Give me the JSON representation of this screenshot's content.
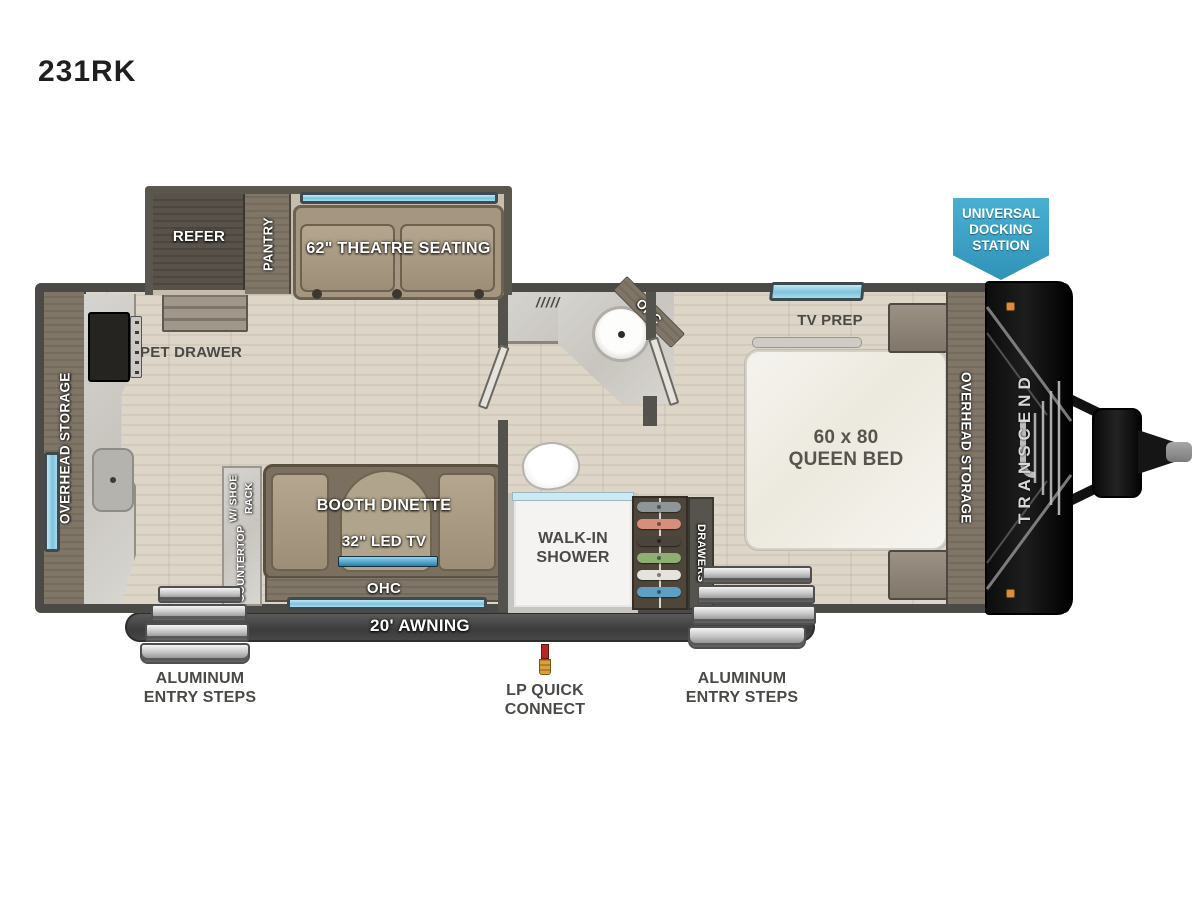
{
  "title": "231RK",
  "badge": {
    "line1": "UNIVERSAL",
    "line2": "DOCKING",
    "line3": "STATION"
  },
  "slideout": {
    "refer": "REFER",
    "pantry": "PANTRY",
    "theatre": "62\" THEATRE SEATING"
  },
  "kitchen": {
    "overhead_storage": "OVERHEAD STORAGE",
    "pet_drawer": "PET DRAWER"
  },
  "dinette": {
    "countertop_line1": "COUNTERTOP",
    "countertop_line2": "W/ SHOE RACK",
    "booth": "BOOTH DINETTE",
    "tv": "32\" LED TV",
    "ohc": "OHC"
  },
  "bath": {
    "vent_marks": "/////",
    "ohc": "OHC",
    "shower_line1": "WALK-IN",
    "shower_line2": "SHOWER",
    "drawers": "DRAWERS"
  },
  "bedroom": {
    "tv_prep": "TV PREP",
    "bed_line1": "60 x 80",
    "bed_line2": "QUEEN BED",
    "overhead_storage": "OVERHEAD STORAGE"
  },
  "front": {
    "brand": "TRANSCEND"
  },
  "exterior": {
    "awning": "20' AWNING",
    "steps_left_line1": "ALUMINUM",
    "steps_left_line2": "ENTRY STEPS",
    "steps_right_line1": "ALUMINUM",
    "steps_right_line2": "ENTRY STEPS",
    "lp_line1": "LP QUICK",
    "lp_line2": "CONNECT"
  },
  "colors": {
    "badge_blue": "#3AA0C5",
    "window_blue": "#A7DCEF",
    "wall_gray": "#4C4A46",
    "floor_wood": "#D7CFC1",
    "cabinet_wood": "#7B7265",
    "sofa_tan": "#A49681",
    "awning_gray": "#3F3F3F",
    "step_silver": "#C9C9C9",
    "cap_black": "#161616",
    "label_gray": "#4B4946"
  }
}
